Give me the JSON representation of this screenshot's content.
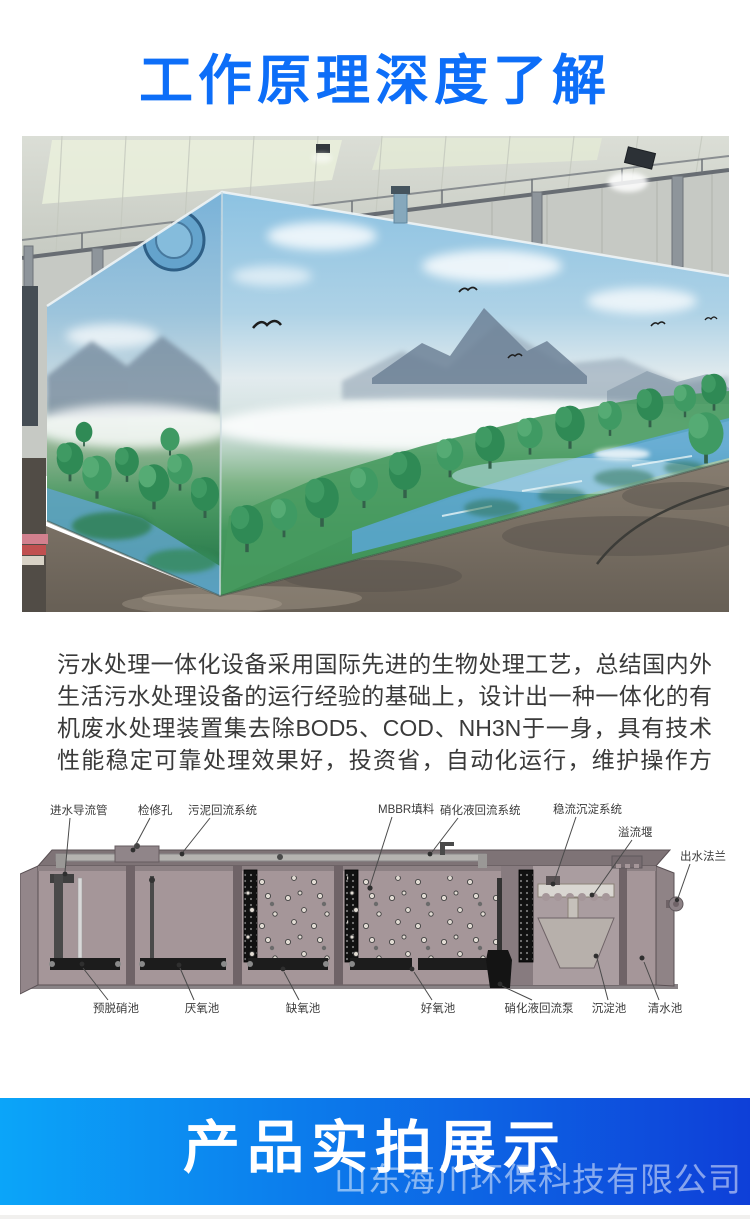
{
  "header": {
    "title": "工作原理深度了解"
  },
  "intro": {
    "text": "污水处理一体化设备采用国际先进的生物处理工艺，总结国内外生活污水处理设备的运行经验的基础上，设计出一种一体化的有机废水处理装置集去除BOD5、COD、NH3N于一身，具有技术性能稳定可靠处理效果好，投资省，自动化运行，维护操作方便。"
  },
  "diagram": {
    "top_labels": [
      "进水导流管",
      "检修孔",
      "污泥回流系统",
      "MBBR填料",
      "硝化液回流系统",
      "稳流沉淀系统",
      "溢流堰",
      "出水法兰"
    ],
    "bottom_labels": [
      "预脱硝池",
      "厌氧池",
      "缺氧池",
      "好氧池",
      "硝化液回流泵",
      "沉淀池",
      "清水池"
    ]
  },
  "banner": {
    "title": "产品实拍展示",
    "watermark": "山东海川环保科技有限公司"
  },
  "colors": {
    "title_blue": "#0d6ef8",
    "banner_gradient_left": "#0ba5f9",
    "banner_gradient_right": "#0e3fd8",
    "body_text": "#3a3a3a"
  }
}
